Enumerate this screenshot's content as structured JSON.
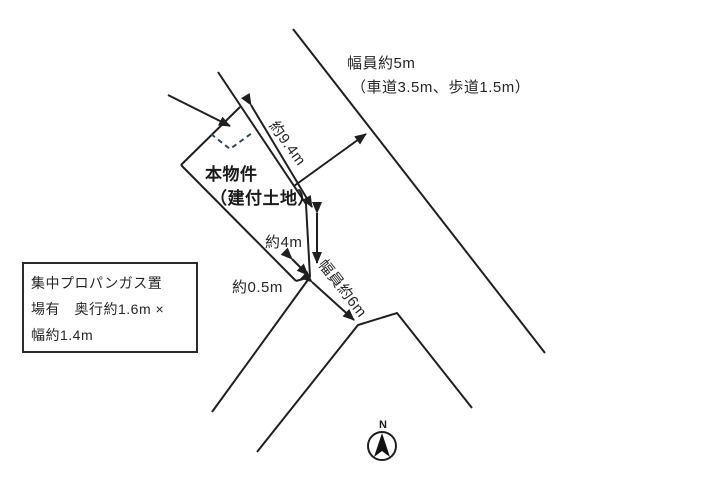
{
  "colors": {
    "line": "#1f1f1f",
    "dash": "#2f4a58",
    "text": "#262626"
  },
  "roads": {
    "top": {
      "width_label": "幅員約5m",
      "detail_label": "（車道3.5m、歩道1.5m）"
    },
    "bottom": {
      "width_label": "幅員約6m"
    }
  },
  "property": {
    "name": "本物件",
    "type": "（建付土地）"
  },
  "measurements": {
    "frontage": "約9.4m",
    "side": "約4m",
    "setback": "約0.5m"
  },
  "note": {
    "line1": "集中プロパンガス置",
    "line2": "場有　奥行約1.6m ×",
    "line3": "幅約1.4m"
  },
  "compass": {
    "north_label": "N"
  }
}
